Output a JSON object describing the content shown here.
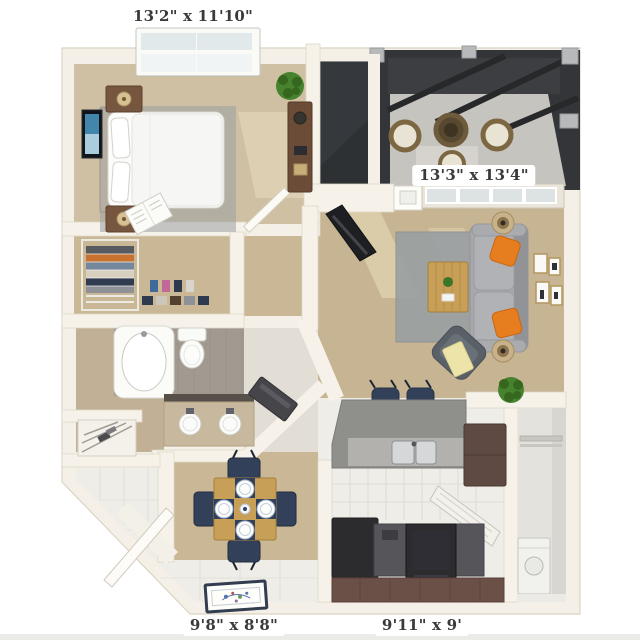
{
  "plan_type": "apartment-floor-plan-3d-top-view",
  "rooms": {
    "bedroom": {
      "name": "bedroom",
      "dimensions": "13'2\" x 11'10\""
    },
    "living_room": {
      "name": "living room",
      "dimensions": "13'3\" x 13'4\""
    },
    "dining_area": {
      "name": "dining area",
      "dimensions": "9'8\" x 8'8\""
    },
    "kitchen": {
      "name": "kitchen",
      "dimensions": "9'11\" x 9'"
    }
  },
  "colors": {
    "background": "#ffffff",
    "wall": "#f4f0e7",
    "wall_edge": "#dcd4c3",
    "carpet_tan": "#c9b795",
    "bedroom_carpet": "#cfbfa3",
    "living_carpet": "#c6b492",
    "tile_white": "#efede8",
    "tile_gray": "#a29a90",
    "bath_beige": "#c2b096",
    "patio_wall": "#333538",
    "patio_floor": "#c6c4bf",
    "sofa_gray": "#a7a8ab",
    "accent_orange": "#e67d1f",
    "navy": "#33405a",
    "wood": "#c79f56",
    "cabinet_brown": "#5e4a42",
    "counter_gray": "#8f8f8c",
    "appliance_dark": "#2c2c2f",
    "plant_green": "#47832f",
    "rug_gray": "#9aa0a2",
    "label_text": "#3a3a3a",
    "label_bg": "#ffffff"
  }
}
